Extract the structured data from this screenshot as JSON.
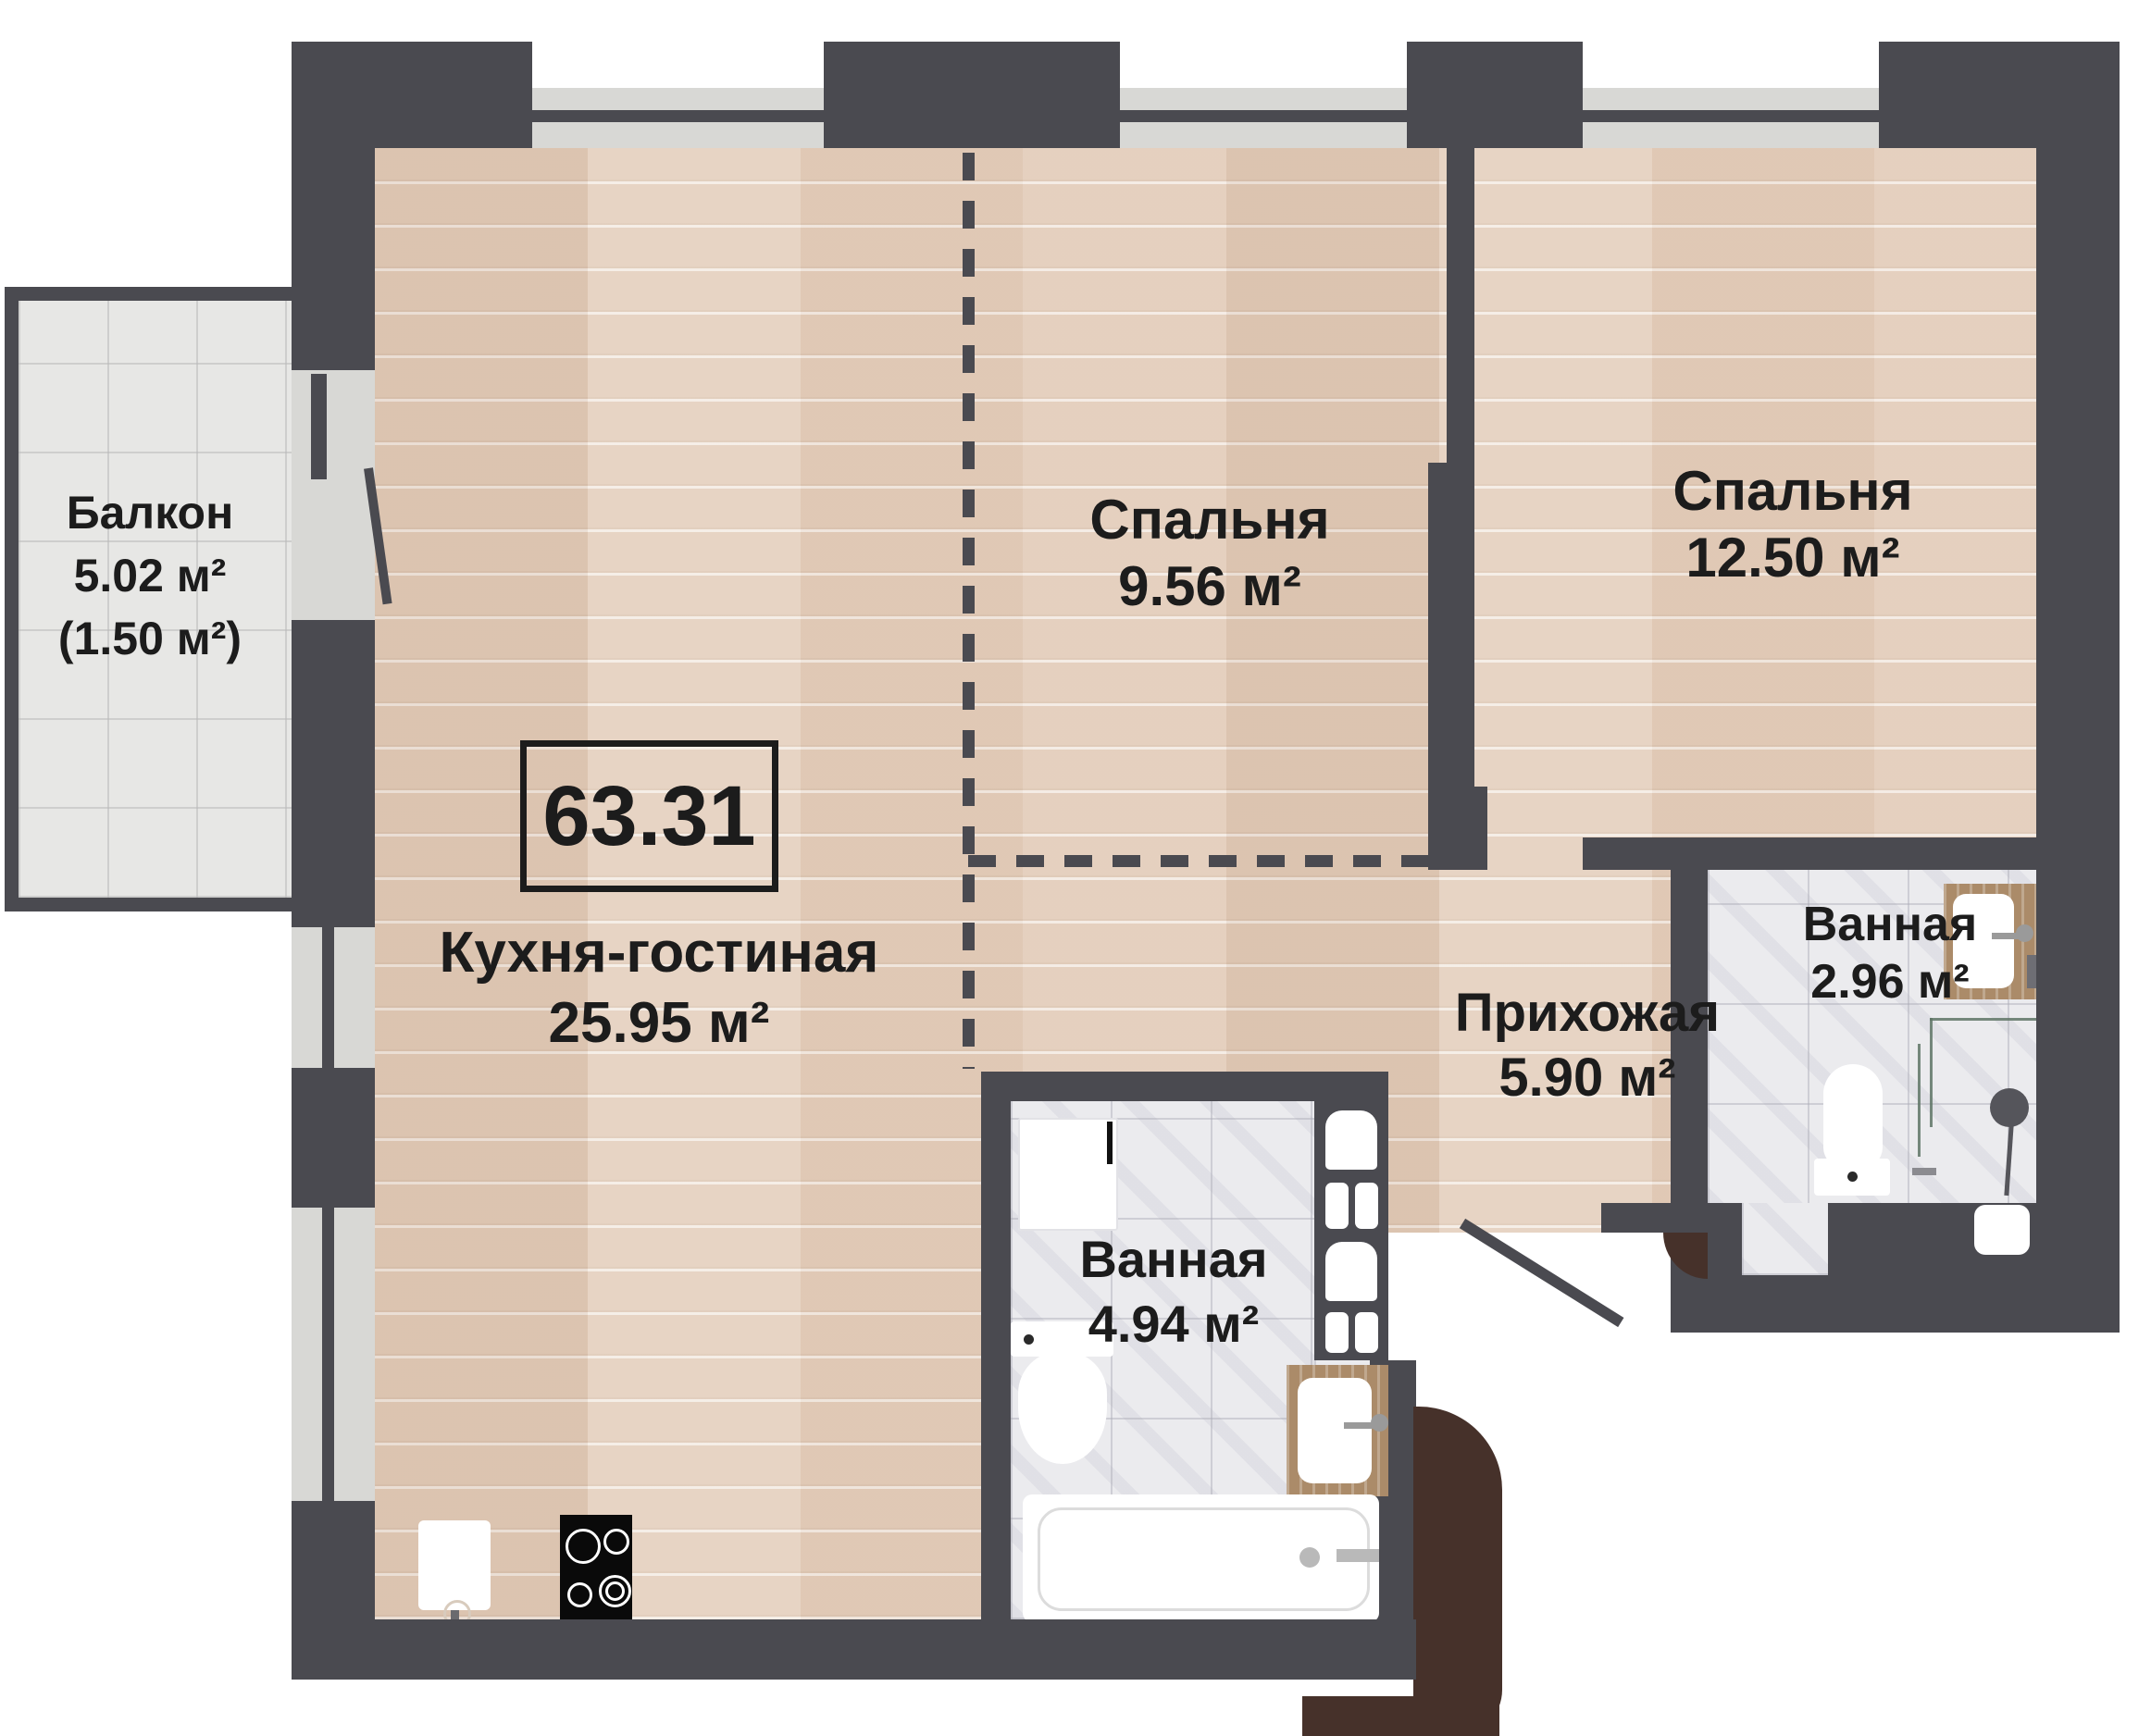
{
  "plan": {
    "title": "apartment-floor-plan",
    "total_area": "63.31",
    "rooms": {
      "balcony": {
        "name": "Балкон",
        "area": "5.02 м²",
        "area_reduced": "(1.50 м²)"
      },
      "kitchen_living": {
        "name": "Кухня-гостиная",
        "area": "25.95 м²"
      },
      "bedroom_small": {
        "name": "Спальня",
        "area": "9.56 м²"
      },
      "bedroom_large": {
        "name": "Спальня",
        "area": "12.50 м²"
      },
      "hallway": {
        "name": "Прихожая",
        "area": "5.90 м²"
      },
      "bathroom_main": {
        "name": "Ванная",
        "area": "4.94 м²"
      },
      "bathroom_second": {
        "name": "Ванная",
        "area": "2.96 м²"
      }
    },
    "fixtures": {
      "kitchen_living": [
        "kitchen-sink",
        "stove"
      ],
      "bathroom_main": [
        "washing-machine",
        "toilet",
        "sink",
        "bathtub",
        "towel-radiator"
      ],
      "bathroom_second": [
        "sink",
        "toilet",
        "shower",
        "washing-machine",
        "dryer"
      ]
    },
    "colors": {
      "wall": "#4a4a50",
      "wood_floor": "#e3cdba",
      "tile_floor": "#ebebee",
      "balcony_tile": "#e7e7e5",
      "window_glass": "#d8d8d5",
      "entrance_accent": "#46312a",
      "shower_glass": "#5f7566",
      "counter_wood": "#ab8b69",
      "text": "#1c1c1c"
    }
  }
}
